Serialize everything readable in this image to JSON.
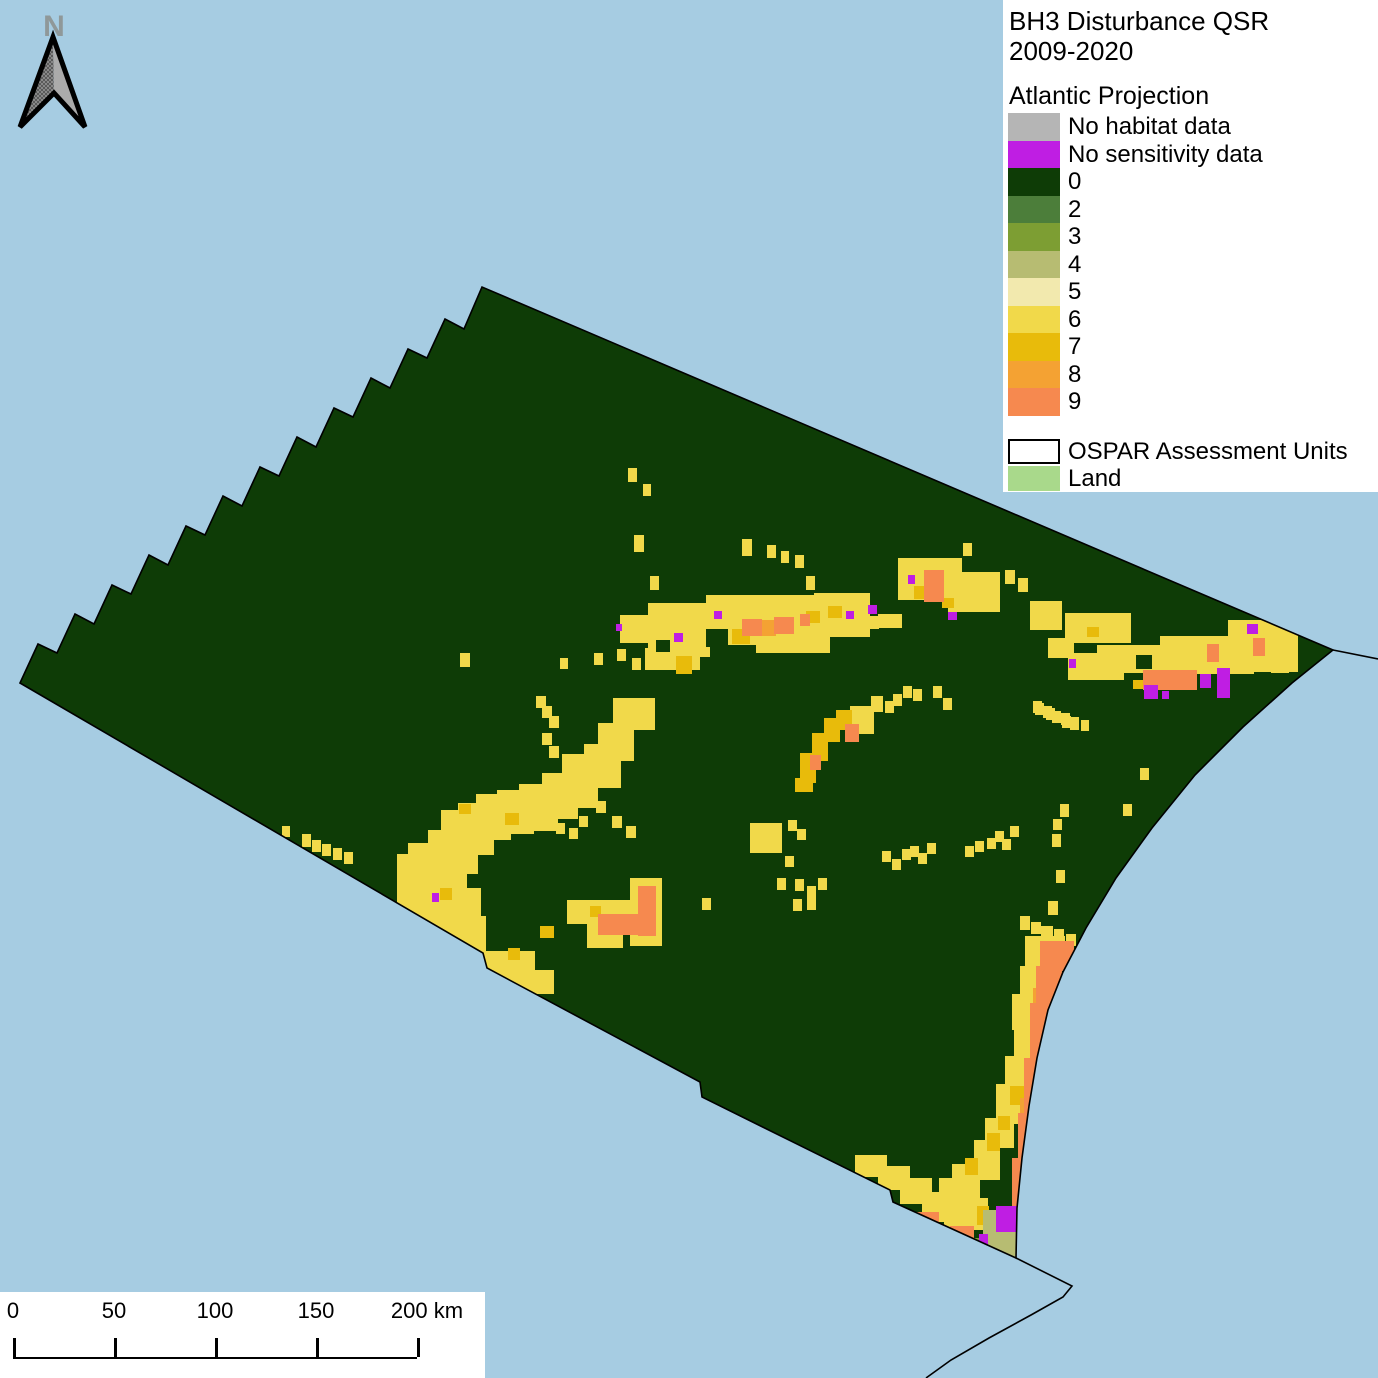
{
  "title": {
    "line1": "BH3 Disturbance QSR",
    "line2": "2009-2020"
  },
  "legend": {
    "section_title": "Atlantic Projection",
    "items": [
      {
        "key": "nhd",
        "label": "No habitat data",
        "color": "#b5b5b5"
      },
      {
        "key": "nsd",
        "label": "No sensitivity data",
        "color": "#bf1ee3"
      },
      {
        "key": "0",
        "label": "0",
        "color": "#0e3c06"
      },
      {
        "key": "2",
        "label": "2",
        "color": "#4c7e3a"
      },
      {
        "key": "3",
        "label": "3",
        "color": "#7d9e33"
      },
      {
        "key": "4",
        "label": "4",
        "color": "#b7bc72"
      },
      {
        "key": "5",
        "label": "5",
        "color": "#f2e9ae"
      },
      {
        "key": "6",
        "label": "6",
        "color": "#f1d94a"
      },
      {
        "key": "7",
        "label": "7",
        "color": "#e8bb0b"
      },
      {
        "key": "8",
        "label": "8",
        "color": "#f4a233"
      },
      {
        "key": "9",
        "label": "9",
        "color": "#f6894f"
      }
    ],
    "overlay_items": [
      {
        "key": "ospar",
        "label": "OSPAR Assessment Units",
        "fill": "#ffffff",
        "border": "#000000"
      },
      {
        "key": "land",
        "label": "Land",
        "fill": "#a9d98b",
        "border": ""
      }
    ]
  },
  "north_arrow": {
    "label": "N"
  },
  "scale_bar": {
    "ticks": [
      "0",
      "50",
      "100",
      "150",
      "200"
    ],
    "unit": "km"
  },
  "map": {
    "ocean_color": "#a6cce2",
    "outline_color": "#000000",
    "outline_path": "M20 683 L38 644 L57 653 L75 614 L94 624 L112 585 L131 594 L149 555 L168 565 L186 526 L205 535 L223 496 L242 506 L260 467 L279 476 L297 437 L316 447 L334 408 L353 417 L371 378 L390 388 L408 349 L427 358 L445 319 L464 329 L482 287 L1333 650 L1292 683 L1243 727 L1195 775 L1152 828 L1116 878 L1086 928 L1063 972 L1048 1010 L1037 1058 L1029 1106 L1022 1158 L1017 1208 L1016 1258 L893 1202 L890 1190 L702 1097 L700 1082 L487 968 L483 953 Z",
    "coast_right_path": "M1333 650 L1378 659",
    "coast_bottom_path": "M1016 1258 L1072 1286 L1063 1297 L1031 1315 L989 1338 L951 1360 L926 1378",
    "cell_order": [
      "6",
      "7",
      "8",
      "9",
      "4",
      "3",
      "0",
      "nsd"
    ],
    "cells": {
      "6": [
        [
          620,
          615,
          45,
          28
        ],
        [
          648,
          603,
          62,
          54
        ],
        [
          706,
          595,
          112,
          50
        ],
        [
          814,
          593,
          56,
          44
        ],
        [
          645,
          648,
          55,
          22
        ],
        [
          756,
          637,
          74,
          16
        ],
        [
          898,
          558,
          64,
          42
        ],
        [
          948,
          572,
          52,
          40
        ],
        [
          878,
          614,
          24,
          14
        ],
        [
          1030,
          601,
          32,
          29
        ],
        [
          1065,
          613,
          66,
          30
        ],
        [
          1048,
          638,
          26,
          20
        ],
        [
          1068,
          653,
          56,
          27
        ],
        [
          1097,
          645,
          98,
          28
        ],
        [
          1160,
          636,
          94,
          38
        ],
        [
          1228,
          620,
          70,
          52
        ],
        [
          1271,
          658,
          18,
          15
        ],
        [
          613,
          698,
          42,
          32
        ],
        [
          598,
          723,
          36,
          38
        ],
        [
          584,
          744,
          37,
          44
        ],
        [
          562,
          754,
          36,
          54
        ],
        [
          542,
          773,
          36,
          46
        ],
        [
          519,
          784,
          39,
          47
        ],
        [
          497,
          790,
          37,
          44
        ],
        [
          476,
          794,
          35,
          46
        ],
        [
          458,
          803,
          36,
          52
        ],
        [
          441,
          810,
          37,
          64
        ],
        [
          428,
          830,
          39,
          64
        ],
        [
          408,
          843,
          36,
          64
        ],
        [
          397,
          854,
          32,
          64
        ],
        [
          399,
          888,
          82,
          50
        ],
        [
          430,
          916,
          56,
          40
        ],
        [
          483,
          951,
          52,
          34
        ],
        [
          516,
          970,
          38,
          24
        ],
        [
          567,
          900,
          76,
          24
        ],
        [
          630,
          878,
          32,
          68
        ],
        [
          587,
          921,
          36,
          27
        ],
        [
          850,
          706,
          24,
          28
        ],
        [
          871,
          696,
          12,
          16
        ],
        [
          1025,
          936,
          40,
          32
        ],
        [
          1020,
          966,
          30,
          32
        ],
        [
          1012,
          994,
          27,
          36
        ],
        [
          1014,
          1028,
          24,
          34
        ],
        [
          1005,
          1056,
          28,
          30
        ],
        [
          996,
          1084,
          30,
          40
        ],
        [
          985,
          1118,
          29,
          30
        ],
        [
          974,
          1140,
          26,
          40
        ],
        [
          952,
          1164,
          28,
          40
        ],
        [
          939,
          1178,
          26,
          30
        ],
        [
          929,
          1194,
          24,
          28
        ],
        [
          956,
          1198,
          32,
          32
        ],
        [
          855,
          1155,
          32,
          22
        ],
        [
          878,
          1166,
          32,
          24
        ],
        [
          900,
          1178,
          32,
          26
        ],
        [
          922,
          1192,
          32,
          26
        ],
        [
          944,
          1206,
          28,
          24
        ],
        [
          742,
          539,
          10,
          17
        ],
        [
          767,
          545,
          9,
          13
        ],
        [
          781,
          551,
          8,
          12
        ],
        [
          795,
          555,
          9,
          13
        ],
        [
          806,
          576,
          9,
          14
        ],
        [
          650,
          576,
          9,
          14
        ],
        [
          634,
          535,
          10,
          17
        ],
        [
          870,
          616,
          9,
          13
        ],
        [
          882,
          615,
          9,
          13
        ],
        [
          963,
          543,
          9,
          13
        ],
        [
          1035,
          703,
          9,
          12
        ],
        [
          1046,
          708,
          9,
          12
        ],
        [
          1061,
          713,
          9,
          12
        ],
        [
          1071,
          717,
          8,
          11
        ],
        [
          1081,
          720,
          8,
          11
        ],
        [
          1005,
          570,
          10,
          14
        ],
        [
          1018,
          578,
          10,
          14
        ],
        [
          536,
          696,
          10,
          12
        ],
        [
          542,
          706,
          10,
          12
        ],
        [
          549,
          716,
          10,
          12
        ],
        [
          542,
          733,
          10,
          12
        ],
        [
          549,
          746,
          10,
          12
        ],
        [
          596,
          801,
          10,
          12
        ],
        [
          612,
          816,
          10,
          12
        ],
        [
          626,
          826,
          10,
          12
        ],
        [
          579,
          816,
          9,
          11
        ],
        [
          556,
          823,
          9,
          11
        ],
        [
          569,
          828,
          9,
          11
        ],
        [
          460,
          653,
          10,
          14
        ],
        [
          560,
          658,
          8,
          11
        ],
        [
          594,
          653,
          9,
          12
        ],
        [
          617,
          649,
          9,
          12
        ],
        [
          632,
          658,
          9,
          12
        ],
        [
          652,
          631,
          9,
          12
        ],
        [
          628,
          468,
          9,
          14
        ],
        [
          643,
          484,
          8,
          12
        ],
        [
          302,
          834,
          9,
          13
        ],
        [
          312,
          840,
          9,
          12
        ],
        [
          322,
          844,
          9,
          12
        ],
        [
          333,
          848,
          9,
          12
        ],
        [
          344,
          852,
          9,
          12
        ],
        [
          282,
          826,
          8,
          11
        ],
        [
          750,
          823,
          32,
          30
        ],
        [
          788,
          820,
          9,
          11
        ],
        [
          797,
          829,
          9,
          11
        ],
        [
          785,
          856,
          9,
          11
        ],
        [
          777,
          878,
          9,
          12
        ],
        [
          795,
          879,
          9,
          12
        ],
        [
          807,
          886,
          9,
          12
        ],
        [
          818,
          878,
          9,
          12
        ],
        [
          793,
          899,
          9,
          12
        ],
        [
          807,
          898,
          9,
          12
        ],
        [
          702,
          898,
          9,
          12
        ],
        [
          882,
          851,
          9,
          11
        ],
        [
          892,
          859,
          9,
          11
        ],
        [
          902,
          849,
          9,
          11
        ],
        [
          910,
          846,
          9,
          11
        ],
        [
          918,
          853,
          9,
          11
        ],
        [
          927,
          843,
          9,
          11
        ],
        [
          965,
          846,
          9,
          11
        ],
        [
          975,
          841,
          9,
          11
        ],
        [
          987,
          838,
          9,
          11
        ],
        [
          995,
          831,
          9,
          11
        ],
        [
          1002,
          839,
          9,
          11
        ],
        [
          1010,
          826,
          9,
          11
        ],
        [
          1033,
          701,
          9,
          12
        ],
        [
          1043,
          706,
          9,
          12
        ],
        [
          1052,
          711,
          9,
          12
        ],
        [
          1062,
          716,
          9,
          12
        ],
        [
          1070,
          718,
          9,
          12
        ],
        [
          1053,
          819,
          9,
          11
        ],
        [
          1123,
          804,
          9,
          12
        ],
        [
          1140,
          768,
          9,
          12
        ],
        [
          885,
          701,
          9,
          12
        ],
        [
          893,
          694,
          9,
          12
        ],
        [
          903,
          686,
          9,
          12
        ],
        [
          913,
          689,
          9,
          12
        ],
        [
          933,
          686,
          9,
          12
        ],
        [
          943,
          698,
          9,
          12
        ],
        [
          1020,
          916,
          10,
          14
        ],
        [
          1031,
          922,
          10,
          12
        ],
        [
          1041,
          926,
          12,
          12
        ],
        [
          1054,
          929,
          10,
          10
        ],
        [
          1066,
          934,
          10,
          12
        ],
        [
          1048,
          901,
          10,
          14
        ],
        [
          1056,
          870,
          9,
          13
        ],
        [
          1052,
          834,
          9,
          13
        ],
        [
          1060,
          804,
          9,
          13
        ]
      ],
      "7": [
        [
          732,
          629,
          18,
          15
        ],
        [
          806,
          611,
          14,
          12
        ],
        [
          828,
          606,
          14,
          12
        ],
        [
          676,
          656,
          16,
          18
        ],
        [
          914,
          586,
          13,
          13
        ],
        [
          942,
          598,
          12,
          10
        ],
        [
          1087,
          627,
          12,
          10
        ],
        [
          1133,
          680,
          10,
          9
        ],
        [
          1220,
          680,
          9,
          9
        ],
        [
          1255,
          641,
          8,
          10
        ],
        [
          505,
          813,
          14,
          12
        ],
        [
          459,
          804,
          12,
          10
        ],
        [
          540,
          926,
          14,
          12
        ],
        [
          508,
          948,
          12,
          12
        ],
        [
          440,
          888,
          12,
          12
        ],
        [
          625,
          915,
          15,
          17
        ],
        [
          590,
          906,
          11,
          11
        ],
        [
          795,
          778,
          18,
          14
        ],
        [
          800,
          753,
          16,
          30
        ],
        [
          812,
          733,
          16,
          28
        ],
        [
          824,
          718,
          16,
          24
        ],
        [
          836,
          710,
          16,
          20
        ],
        [
          1050,
          953,
          14,
          18
        ],
        [
          1030,
          1036,
          14,
          22
        ],
        [
          1010,
          1086,
          14,
          19
        ],
        [
          987,
          1133,
          13,
          18
        ],
        [
          977,
          1206,
          12,
          19
        ],
        [
          965,
          1158,
          13,
          17
        ],
        [
          998,
          1116,
          12,
          14
        ],
        [
          1008,
          1240,
          10,
          8
        ],
        [
          996,
          1252,
          10,
          8
        ],
        [
          905,
          1219,
          12,
          10
        ]
      ],
      "8": [
        [
          760,
          620,
          16,
          16
        ],
        [
          1033,
          988,
          16,
          22
        ],
        [
          1020,
          1098,
          14,
          22
        ]
      ],
      "9": [
        [
          742,
          619,
          20,
          17
        ],
        [
          774,
          617,
          20,
          17
        ],
        [
          800,
          614,
          10,
          12
        ],
        [
          924,
          570,
          20,
          32
        ],
        [
          1143,
          670,
          54,
          20
        ],
        [
          1207,
          644,
          12,
          18
        ],
        [
          1253,
          638,
          12,
          18
        ],
        [
          598,
          914,
          42,
          21
        ],
        [
          638,
          886,
          18,
          50
        ],
        [
          845,
          724,
          14,
          18
        ],
        [
          810,
          755,
          11,
          15
        ],
        [
          1040,
          941,
          34,
          30
        ],
        [
          1036,
          966,
          26,
          42
        ],
        [
          1030,
          1003,
          24,
          60
        ],
        [
          1024,
          1058,
          20,
          62
        ],
        [
          1018,
          1113,
          20,
          52
        ],
        [
          1012,
          1158,
          20,
          57
        ],
        [
          1000,
          1208,
          26,
          50
        ],
        [
          985,
          1228,
          30,
          30
        ],
        [
          917,
          1212,
          22,
          18
        ],
        [
          950,
          1226,
          24,
          20
        ]
      ],
      "4": [
        [
          983,
          1210,
          36,
          50
        ]
      ],
      "3": [
        [
          972,
          1238,
          14,
          14
        ],
        [
          988,
          1254,
          12,
          10
        ]
      ],
      "0": [
        [
          706,
          629,
          22,
          18
        ],
        [
          656,
          640,
          14,
          12
        ],
        [
          1136,
          655,
          16,
          14
        ]
      ],
      "nsd": [
        [
          674,
          633,
          9,
          9
        ],
        [
          714,
          611,
          8,
          8
        ],
        [
          846,
          611,
          8,
          8
        ],
        [
          868,
          605,
          9,
          9
        ],
        [
          616,
          624,
          6,
          7
        ],
        [
          908,
          575,
          7,
          9
        ],
        [
          948,
          612,
          9,
          8
        ],
        [
          1069,
          659,
          7,
          9
        ],
        [
          1144,
          685,
          14,
          14
        ],
        [
          1162,
          691,
          7,
          8
        ],
        [
          1200,
          674,
          11,
          14
        ],
        [
          1217,
          668,
          13,
          30
        ],
        [
          1247,
          624,
          11,
          10
        ],
        [
          432,
          893,
          7,
          9
        ],
        [
          996,
          1206,
          23,
          26
        ],
        [
          979,
          1234,
          9,
          11
        ]
      ]
    }
  }
}
